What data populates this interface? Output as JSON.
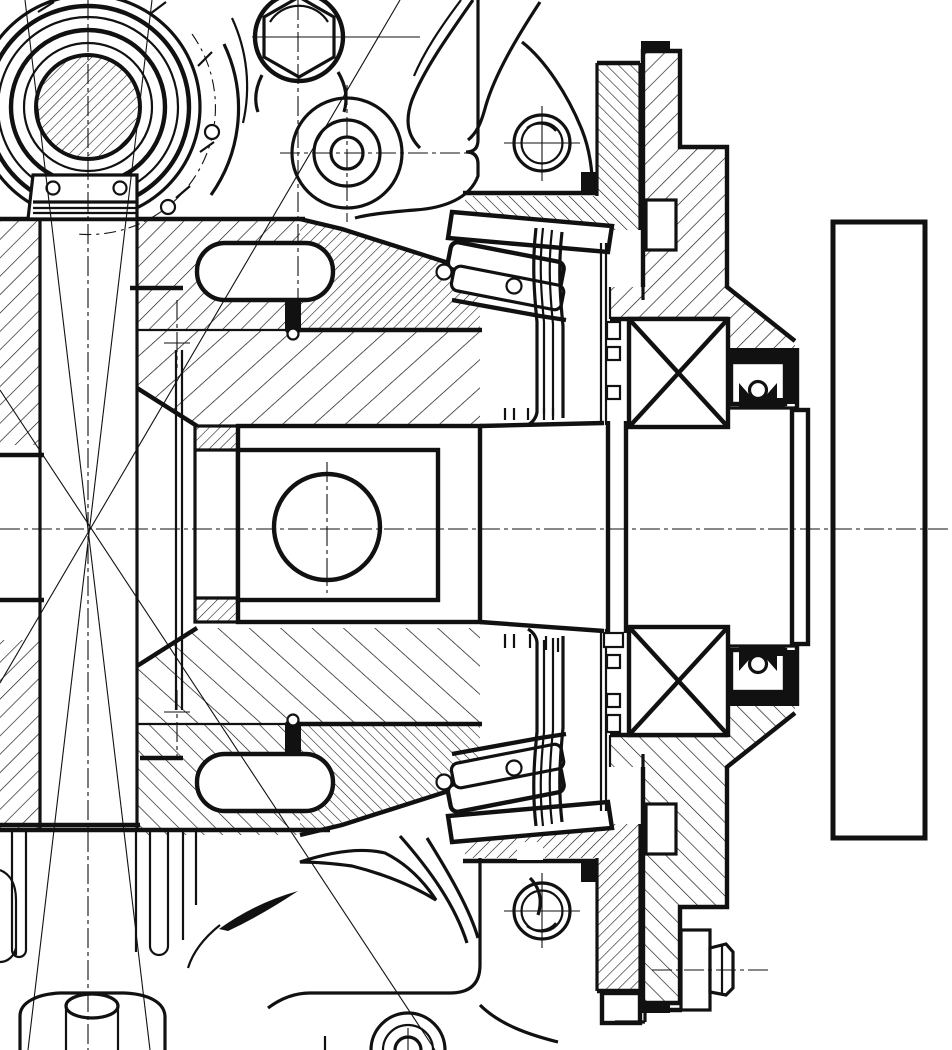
{
  "drawing": {
    "title": "gearbox-final-drive-cross-section",
    "colors": {
      "line": "#111111",
      "background": "#ffffff"
    },
    "parts": [
      "bearing-cover-front-view",
      "cover-bracket",
      "hex-plug",
      "bore-boss",
      "housing-webs",
      "bearing-carrier",
      "tapered-roller-bearing-upper",
      "tapered-roller-bearing-lower",
      "yoke-block",
      "yoke-bore",
      "tapered-shaft",
      "ball-bearing-upper",
      "ball-bearing-lower",
      "lip-seal-upper",
      "lip-seal-lower",
      "output-stub-shaft",
      "companion-flange",
      "flange-bolt",
      "housing-lower-ribs",
      "drain-boss-cylinder"
    ]
  }
}
